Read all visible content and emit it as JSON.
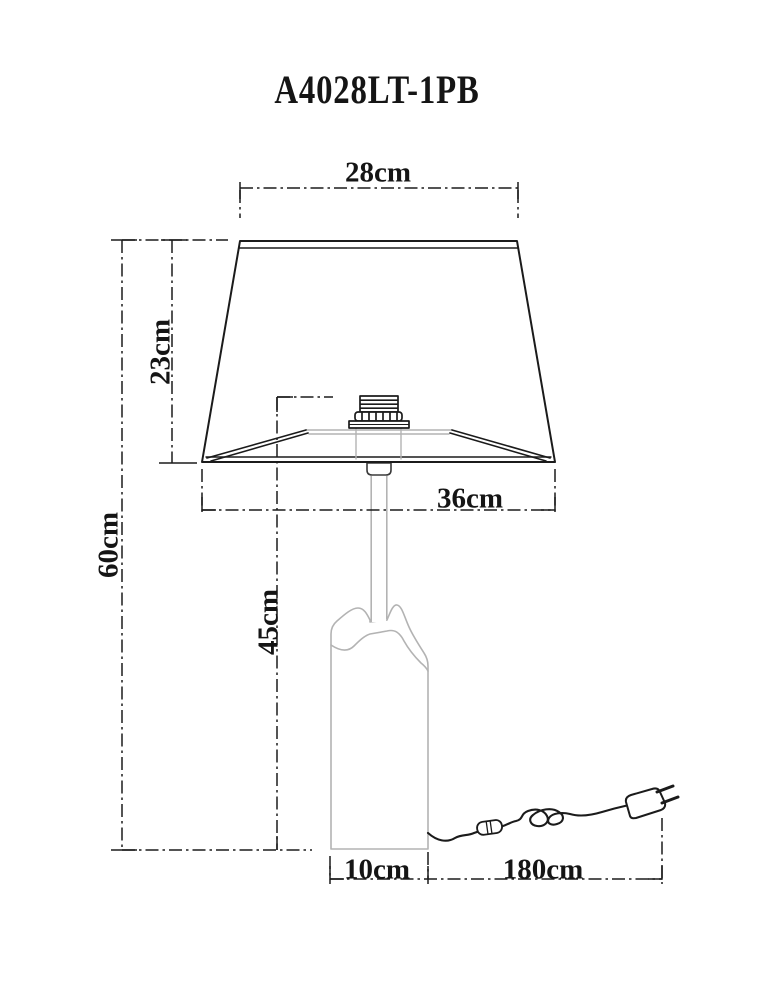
{
  "title": "A4028LT-1PB",
  "labels": {
    "shade_top_width": "28cm",
    "shade_height": "23cm",
    "total_height": "60cm",
    "stand_height": "45cm",
    "shade_bottom_width": "36cm",
    "base_width": "10cm",
    "cord_length": "180cm"
  },
  "colors": {
    "background": "#ffffff",
    "ink": "#1b1b1b",
    "glass_line": "#b3b3b3"
  },
  "parts": [
    "lampshade",
    "lamp-socket",
    "shade-fitter",
    "stem",
    "glass-base",
    "power-cord",
    "inline-switch",
    "euro-plug"
  ]
}
